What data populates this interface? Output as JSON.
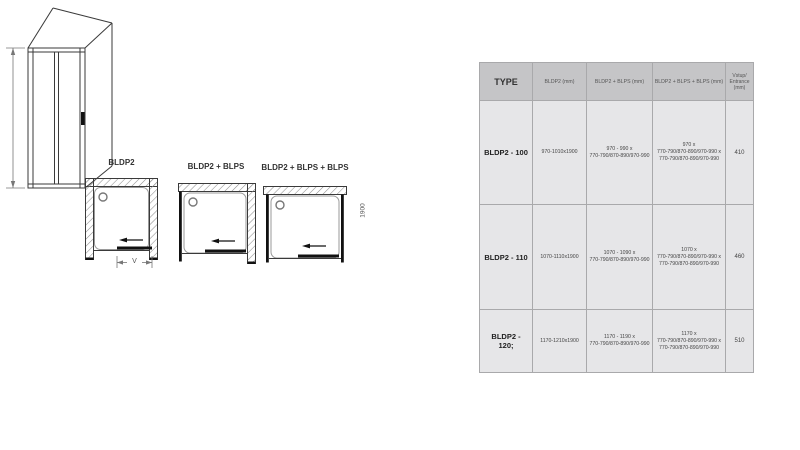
{
  "diagrams": {
    "label_1": "BLDP2",
    "label_2": "BLDP2 + BLPS",
    "label_3": "BLDP2 + BLPS + BLPS",
    "v_label": "V",
    "height_label": "1900"
  },
  "table": {
    "headers": [
      "TYPE",
      "BLDP2 (mm)",
      "BLDP2 + BLPS (mm)",
      "BLDP2 + BLPS + BLPS (mm)",
      "Vstup/\nEntrance\n(mm)"
    ],
    "rows": [
      {
        "cells": [
          "BLDP2 - 100",
          "970-1010x1900",
          "970 - 990 x\n770-790/870-890/970-990",
          "970 x\n770-790/870-890/970-990 x\n770-790/870-890/970-990",
          "410"
        ]
      },
      {
        "cells": [
          "BLDP2 - 110",
          "1070-1110x1900",
          "1070 - 1090 x\n770-790/870-890/970-990",
          "1070 x\n770-790/870-890/970-990 x\n770-790/870-890/970-990",
          "460"
        ]
      },
      {
        "cells": [
          "BLDP2 -\n120;",
          "1170-1210x1900",
          "1170 - 1190 x\n770-790/870-890/970-990",
          "1170 x\n770-790/870-890/970-990 x\n770-790/870-890/970-990",
          "510"
        ]
      }
    ]
  },
  "colors": {
    "header_bg": "#c5c5c7",
    "body_bg": "#e6e6e8",
    "grid_line": "#a9a9ab",
    "line_art": "#3a3a3a"
  }
}
